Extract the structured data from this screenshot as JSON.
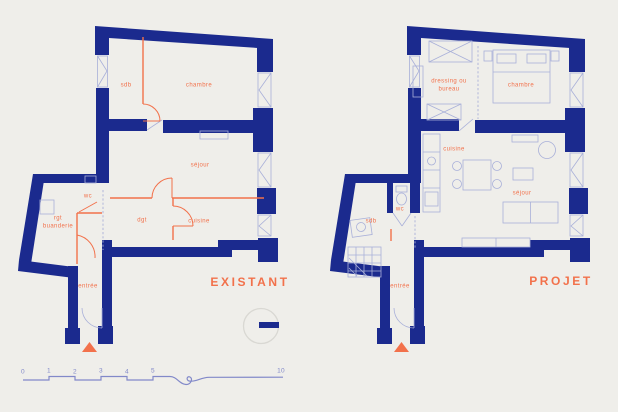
{
  "palette": {
    "background": "#efeeea",
    "wall-navy": "#1b2a8e",
    "accent-orange": "#f2714b",
    "detail-blue": "#a9b0d9",
    "scale-blue": "#8289c9",
    "circle-gray": "#d9d8d3"
  },
  "plans": {
    "existant": {
      "title": "EXISTANT",
      "rooms": {
        "sdb": "sdb",
        "chambre": "chambre",
        "sejour": "séjour",
        "wc": "wc",
        "rgt_line1": "rgt",
        "rgt_line2": "buanderie",
        "dgt": "dgt",
        "cuisine": "cuisine",
        "entree": "entrée"
      }
    },
    "projet": {
      "title": "PROJET",
      "rooms": {
        "dressing_line1": "dressing ou",
        "dressing_line2": "bureau",
        "chambre": "chambre",
        "cuisine": "cuisine",
        "sejour": "séjour",
        "sdb": "sdb",
        "wc": "wc",
        "entree": "entrée"
      }
    }
  },
  "scale_bar": {
    "ticks": [
      "0",
      "1",
      "2",
      "3",
      "4",
      "5"
    ],
    "end_label": "10"
  }
}
